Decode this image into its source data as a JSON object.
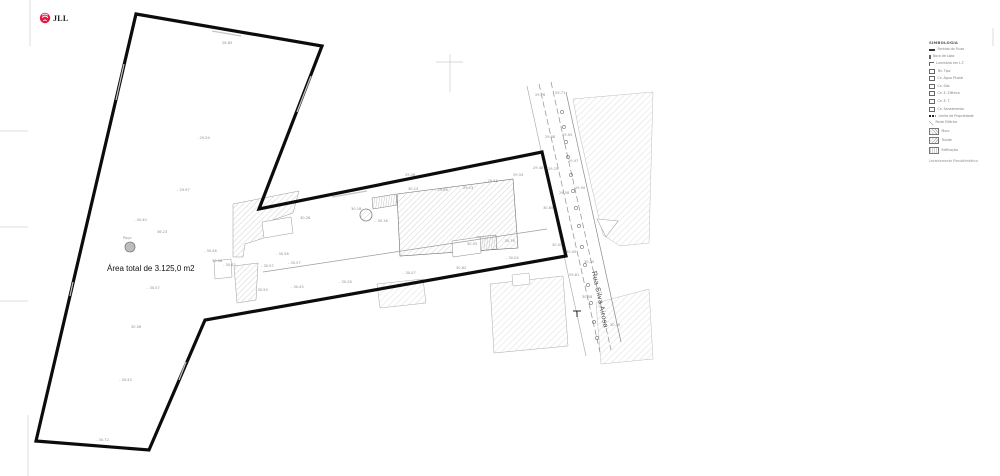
{
  "brand": {
    "name": "JLL"
  },
  "plan": {
    "area_label": "Área total de 3.125,0 m2",
    "street_name": "Rua Silva Airosa"
  },
  "legend": {
    "title": "SIMBOLOGIA",
    "caption": "Levantamento Planialtimétrico",
    "items": [
      {
        "icon": "line",
        "label": "Sentido do Fluxo"
      },
      {
        "icon": "post",
        "label": "Boca de Lobo"
      },
      {
        "icon": "lamp",
        "label": "Luminária em L.T."
      },
      {
        "icon": "box",
        "label": "Tel. Tipo"
      },
      {
        "icon": "box",
        "label": "Cx. Água Pluvial"
      },
      {
        "icon": "box",
        "label": "Cx. Gás"
      },
      {
        "icon": "box",
        "label": "Cx. E. Elétrica"
      },
      {
        "icon": "box",
        "label": "Cx. E. T."
      },
      {
        "icon": "box",
        "label": "Cx. Saneamento"
      },
      {
        "icon": "dash",
        "label": "Limite de Propriedade"
      },
      {
        "icon": "slash",
        "label": "Poste Elétrico"
      },
      {
        "icon": "swatch1",
        "label": "Muro"
      },
      {
        "icon": "swatch2",
        "label": "Talude"
      },
      {
        "icon": "swatch3",
        "label": "Edificação"
      }
    ]
  },
  "elevation_points": [
    {
      "x": 197,
      "y": 139,
      "label": "- 29.54"
    },
    {
      "x": 177,
      "y": 191,
      "label": "- 29.97"
    },
    {
      "x": 134,
      "y": 221,
      "label": "- 30.40"
    },
    {
      "x": 157,
      "y": 233,
      "label": "36.23"
    },
    {
      "x": 123,
      "y": 239,
      "label": "Poço"
    },
    {
      "x": 204,
      "y": 252,
      "label": "- 30.46"
    },
    {
      "x": 212,
      "y": 262,
      "label": "30.58"
    },
    {
      "x": 223,
      "y": 266,
      "label": "- 30.62"
    },
    {
      "x": 147,
      "y": 289,
      "label": "- 30.07"
    },
    {
      "x": 131,
      "y": 328,
      "label": "30.56"
    },
    {
      "x": 119,
      "y": 381,
      "label": "- 30.43"
    },
    {
      "x": 96,
      "y": 441,
      "label": "- 30.72"
    },
    {
      "x": 222,
      "y": 44,
      "label": "26.85"
    },
    {
      "x": 300,
      "y": 219,
      "label": "30.26"
    },
    {
      "x": 276,
      "y": 255,
      "label": "- 30.56"
    },
    {
      "x": 261,
      "y": 267,
      "label": "- 30.57"
    },
    {
      "x": 288,
      "y": 264,
      "label": "- 30.57"
    },
    {
      "x": 255,
      "y": 291,
      "label": "- 30.59"
    },
    {
      "x": 291,
      "y": 288,
      "label": "- 30.45"
    },
    {
      "x": 339,
      "y": 283,
      "label": "- 30.26"
    },
    {
      "x": 351,
      "y": 210,
      "label": "30.18"
    },
    {
      "x": 375,
      "y": 222,
      "label": "- 30.16"
    },
    {
      "x": 405,
      "y": 176,
      "label": "29.28"
    },
    {
      "x": 408,
      "y": 190,
      "label": "30.14"
    },
    {
      "x": 435,
      "y": 191,
      "label": "- 29.06"
    },
    {
      "x": 463,
      "y": 189,
      "label": "29.13"
    },
    {
      "x": 485,
      "y": 182,
      "label": "- 29.55"
    },
    {
      "x": 513,
      "y": 176,
      "label": "29.54"
    },
    {
      "x": 535,
      "y": 96,
      "label": "29.76"
    },
    {
      "x": 555,
      "y": 94,
      "label": "29.71"
    },
    {
      "x": 545,
      "y": 138,
      "label": "29.08"
    },
    {
      "x": 562,
      "y": 136,
      "label": "29.05"
    },
    {
      "x": 568,
      "y": 162,
      "label": "29.47"
    },
    {
      "x": 533,
      "y": 169,
      "label": "29.48"
    },
    {
      "x": 548,
      "y": 170,
      "label": "29.25"
    },
    {
      "x": 575,
      "y": 189,
      "label": "29.50"
    },
    {
      "x": 559,
      "y": 194,
      "label": "29.58"
    },
    {
      "x": 543,
      "y": 209,
      "label": "30.85"
    },
    {
      "x": 552,
      "y": 246,
      "label": "30.05"
    },
    {
      "x": 502,
      "y": 242,
      "label": "- 30.76"
    },
    {
      "x": 467,
      "y": 245,
      "label": "30.55"
    },
    {
      "x": 506,
      "y": 259,
      "label": "- 30.04"
    },
    {
      "x": 403,
      "y": 274,
      "label": "- 30.07"
    },
    {
      "x": 456,
      "y": 269,
      "label": "30.62"
    },
    {
      "x": 566,
      "y": 253,
      "label": "30.05"
    },
    {
      "x": 584,
      "y": 263,
      "label": "30.25"
    },
    {
      "x": 582,
      "y": 298,
      "label": "30.58"
    },
    {
      "x": 610,
      "y": 326,
      "label": "30.30"
    },
    {
      "x": 569,
      "y": 276,
      "label": "29.81"
    }
  ]
}
